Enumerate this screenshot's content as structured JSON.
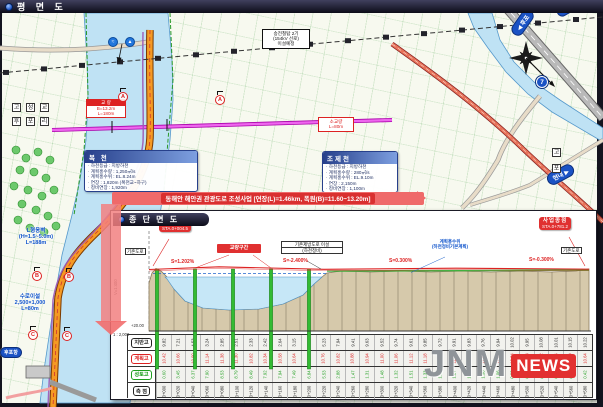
{
  "window": {
    "title": "평 면 도",
    "inset_title": "종 단 면 도"
  },
  "colors": {
    "accent_red": "#e03030",
    "sign_blue": "#1a52c4",
    "banner_pink": "#ef6a6a",
    "pier_green": "#33bb33",
    "water": "#bfe2f4",
    "ground_tan": "#d6c9ab"
  },
  "banner": {
    "text": "동해안 해안권 관광도로 조성사업 [연장(L)=1.46km, 폭원(B)=11.60~13.20m]"
  },
  "map": {
    "labels": {
      "transmission": {
        "line1": "송전철탑 2기",
        "line2": "(154kV 선로)",
        "line3": "이설예정"
      },
      "bridge1": {
        "title": "교 량",
        "line1": "B=13.2m",
        "line2": "L=180m"
      },
      "bridge2": {
        "line1": "소교량",
        "line2": "L=80m"
      },
      "retaining_wall": {
        "line1": "L형옹벽",
        "line2": "(H=1.5~5.0m)",
        "line3": "L=188m"
      },
      "waterway": {
        "line1": "수로이설",
        "line2": "2,500×1,000",
        "line3": "L=80m"
      },
      "harbor_sign": "후포항",
      "sign_hupo": "◀ 후포",
      "sign_hyeonnae": "현내 ▶",
      "sign_geumeum": "금음",
      "route_no": "7",
      "facility1": "≈",
      "facility2": "▲",
      "grid_chars1": [
        "고",
        "성",
        "교"
      ],
      "grid_chars2": [
        "후",
        "포",
        "리"
      ],
      "grid_right": [
        "고",
        "포"
      ],
      "section_markers": [
        "A",
        "A",
        "B",
        "B",
        "C",
        "C"
      ]
    },
    "info_box1": {
      "title": "복 천",
      "lines": [
        "하천등급 : 지방하천",
        "계획홍수량 : 1,250㎥/s",
        "계획홍수위 : EL.8.24m",
        "연장 : 1,820m (복천교~하구)",
        "정비연장 : 1,920m"
      ]
    },
    "info_box2": {
      "title": "조제천",
      "lines": [
        "하천등급 : 지방하천",
        "계획홍수량 : 280㎥/s",
        "계획홍수위 : EL.9.10m",
        "연장 : 2,150m",
        "정비연장 : 1,100m"
      ]
    }
  },
  "profile": {
    "start_label": {
      "title": "사업시점",
      "sta": "STA.0+004.5"
    },
    "end_label": {
      "title": "사업종점",
      "sta": "STA.0+781.2"
    },
    "notes": {
      "left_road": "기존도로",
      "relocation1": "기존제방도로 이설",
      "relocation2": "(하천정비)",
      "flood1": "계획홍수위",
      "flood2": "(하천정비기본계획)",
      "right_road": "기존도로"
    },
    "datum": "+20.00",
    "scale_h": "1 : 2,000",
    "scale_v": "V=1:400",
    "table": {
      "rows": [
        {
          "header": "지반고",
          "bind": "chart_data.ground",
          "color": "black"
        },
        {
          "header": "계획고",
          "bind": "chart_data.plan",
          "color": "red"
        },
        {
          "header": "성토고",
          "bind": "chart_data.fill",
          "color": "green"
        },
        {
          "header": "측 점",
          "bind": "chart_data.stations",
          "color": "black"
        }
      ]
    }
  },
  "chart_data": {
    "type": "area",
    "title": "종단면도",
    "bridge_zone": "교량구간",
    "start": "STA.0+004.5",
    "end": "STA.0+781.2",
    "grades": [
      "S=1.202%",
      "S=-2.400%",
      "S=0.300%",
      "S=-0.300%"
    ],
    "datum": "+20.00",
    "stations": [
      "0+000",
      "0+020",
      "0+040",
      "0+060",
      "0+080",
      "0+100",
      "0+120",
      "0+140",
      "0+160",
      "0+180",
      "0+200",
      "0+220",
      "0+240",
      "0+260",
      "0+280",
      "0+300",
      "0+320",
      "0+340",
      "0+360",
      "0+380",
      "0+400",
      "0+420",
      "0+440",
      "0+460",
      "0+480",
      "0+500",
      "0+520",
      "0+540",
      "0+560",
      "0+580"
    ],
    "ground": [
      "9.82",
      "7.21",
      "4.53",
      "3.24",
      "2.85",
      "2.51",
      "2.33",
      "2.42",
      "2.64",
      "3.15",
      "3.86",
      "5.23",
      "7.94",
      "9.41",
      "9.63",
      "9.52",
      "9.74",
      "9.61",
      "9.85",
      "9.72",
      "9.91",
      "9.83",
      "9.76",
      "9.94",
      "10.02",
      "9.95",
      "10.08",
      "10.01",
      "10.15",
      "10.22"
    ],
    "plan": [
      "10.42",
      "10.66",
      "10.90",
      "11.14",
      "11.38",
      "11.30",
      "10.82",
      "10.34",
      "10.58",
      "10.64",
      "10.70",
      "10.76",
      "10.82",
      "10.88",
      "10.94",
      "11.00",
      "11.06",
      "11.12",
      "11.18",
      "11.24",
      "11.18",
      "11.12",
      "11.06",
      "11.00",
      "10.94",
      "10.88",
      "10.82",
      "10.76",
      "10.70",
      "10.64"
    ],
    "fill": [
      "0.60",
      "3.45",
      "6.37",
      "7.90",
      "8.53",
      "8.79",
      "8.49",
      "7.92",
      "7.94",
      "7.49",
      "6.84",
      "5.53",
      "2.88",
      "1.47",
      "1.31",
      "1.48",
      "1.32",
      "1.51",
      "1.33",
      "1.52",
      "1.27",
      "1.29",
      "1.30",
      "1.06",
      "0.92",
      "0.93",
      "0.74",
      "0.75",
      "0.55",
      "0.42"
    ]
  },
  "watermark": {
    "jnm": "JNM",
    "news": "NEWS"
  }
}
